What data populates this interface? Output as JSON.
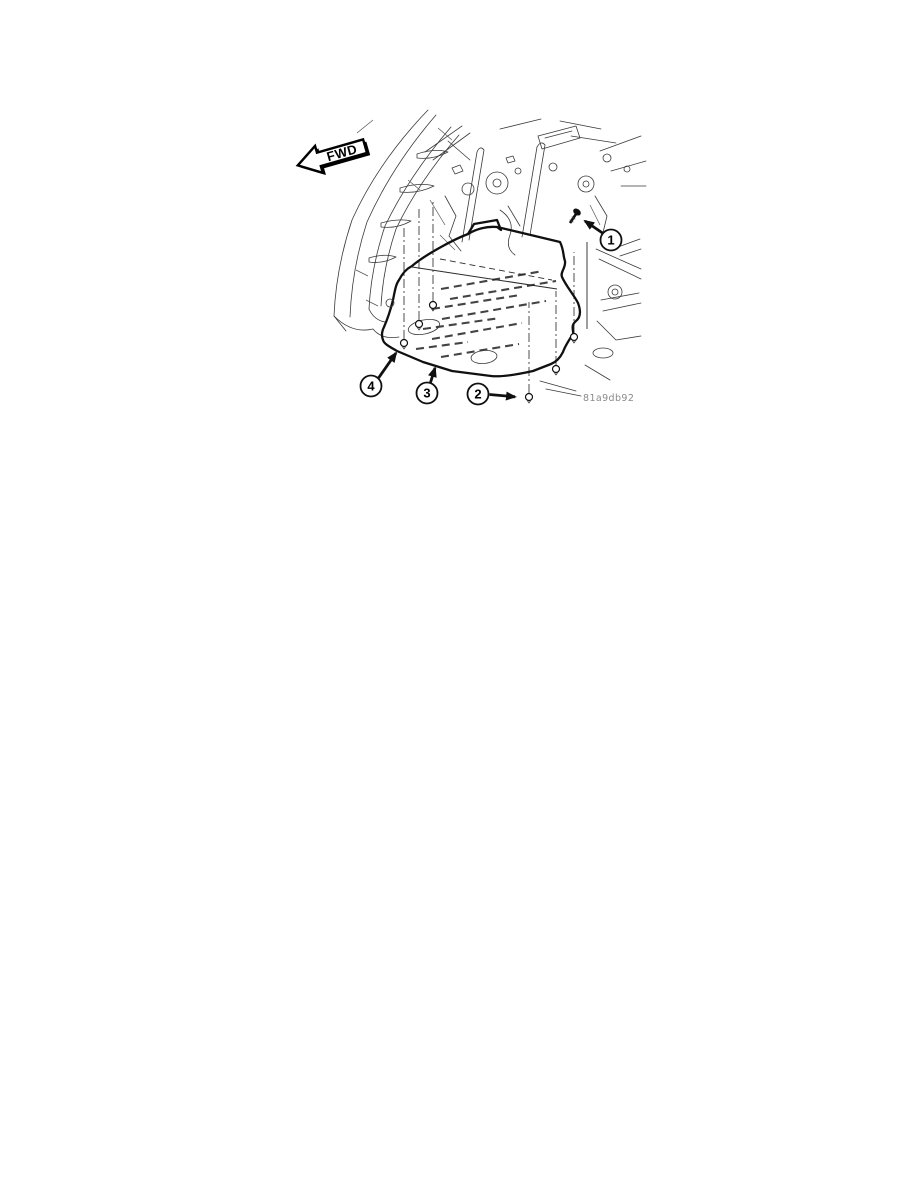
{
  "figure": {
    "direction_label": "FWD",
    "figure_code": "81a9db92",
    "callouts": [
      {
        "label": "1"
      },
      {
        "label": "2"
      },
      {
        "label": "3"
      },
      {
        "label": "4"
      }
    ],
    "colors": {
      "background": "#ffffff",
      "line": "#101010",
      "code_text": "#8a8a8a"
    }
  }
}
